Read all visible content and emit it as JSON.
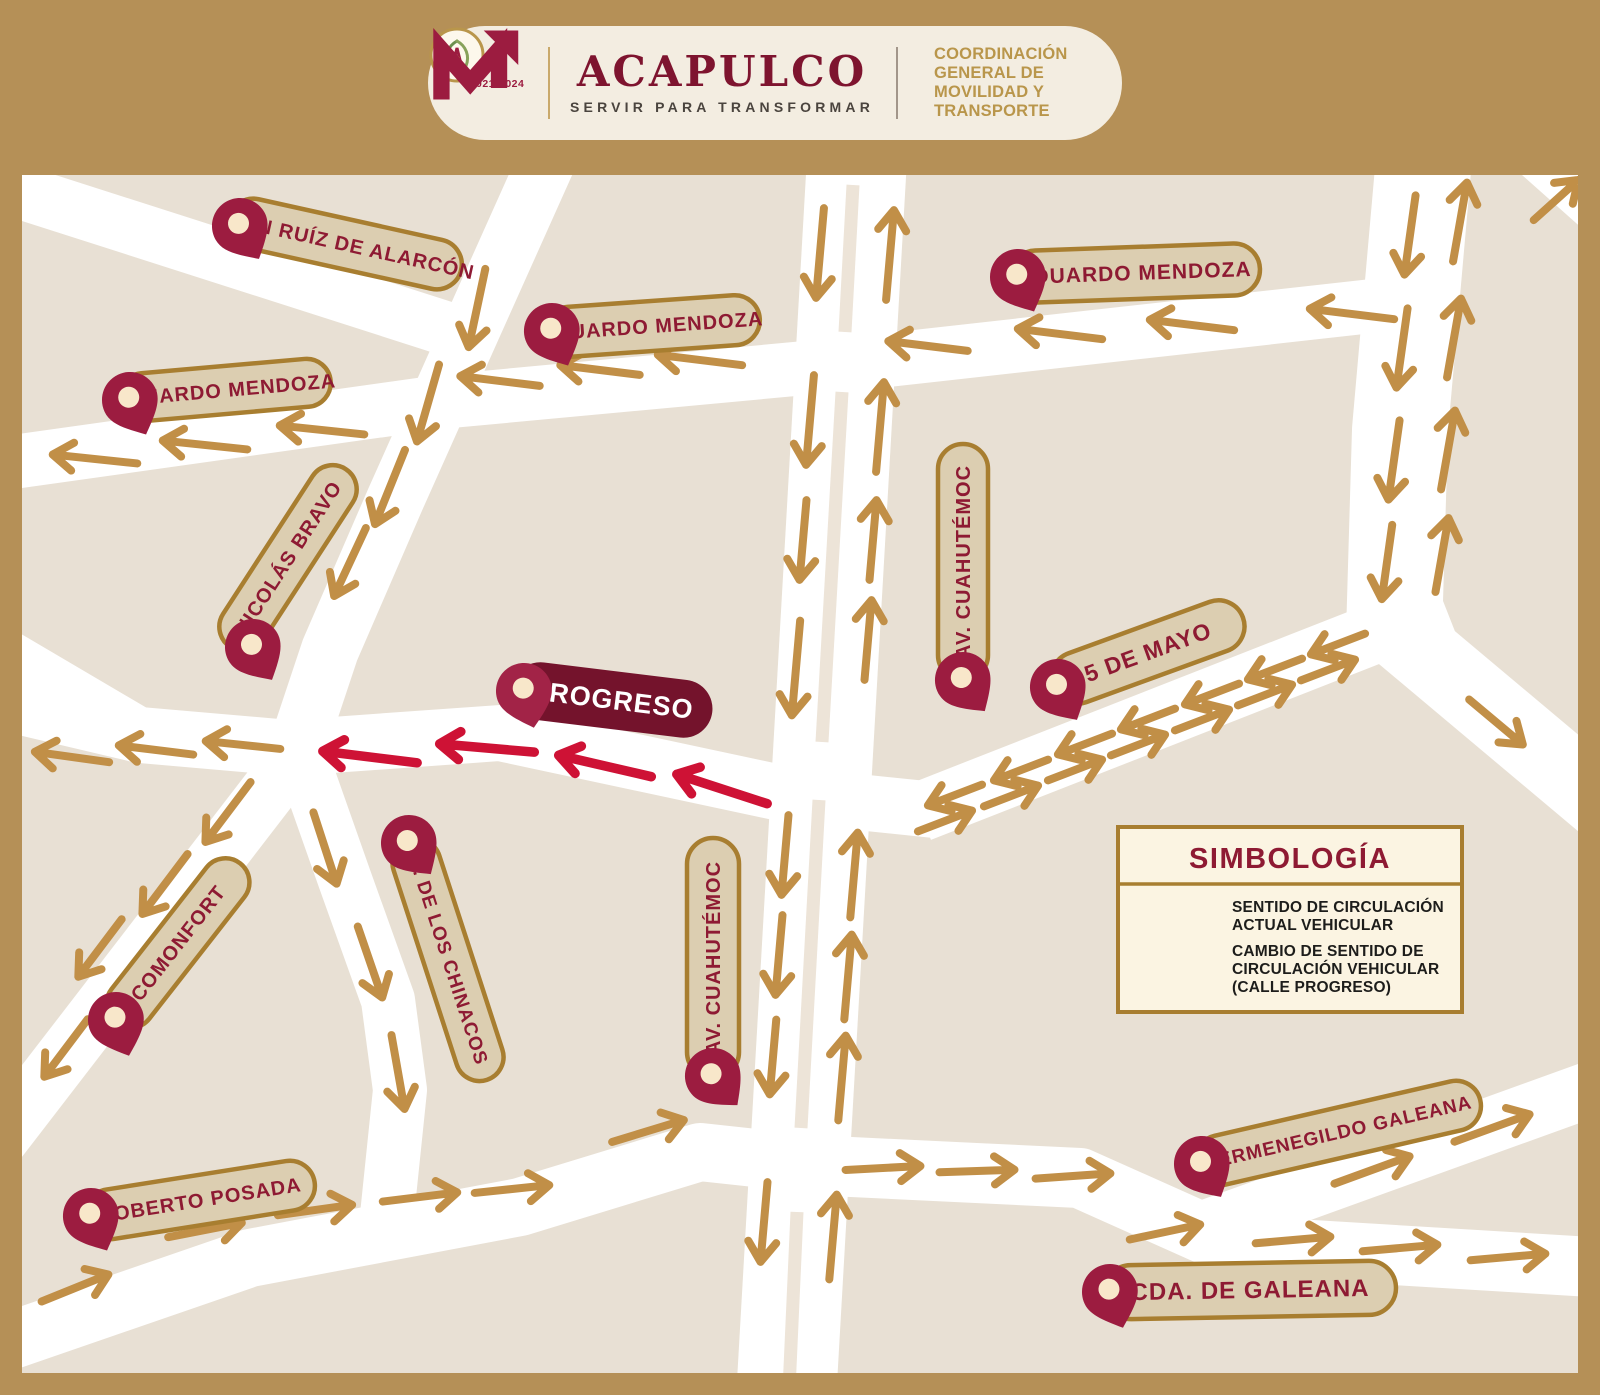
{
  "header": {
    "term": "2021-2024",
    "brand": "ACAPULCO",
    "tagline": "SERVIR PARA TRANSFORMAR",
    "agency_lines": [
      "COORDINACIÓN",
      "GENERAL DE",
      "MOVILIDAD Y",
      "TRANSPORTE"
    ]
  },
  "map": {
    "street_labels": [
      {
        "id": "juan-ruiz-de-alarcon",
        "text": "JUAN RUÍZ DE ALARCÓN"
      },
      {
        "id": "eduardo-mendoza-west",
        "text": "EDUARDO MENDOZA"
      },
      {
        "id": "eduardo-mendoza-center",
        "text": "EDUARDO MENDOZA"
      },
      {
        "id": "eduardo-mendoza-east",
        "text": "EDUARDO MENDOZA"
      },
      {
        "id": "nicolas-bravo",
        "text": "NICOLÁS BRAVO"
      },
      {
        "id": "progreso",
        "text": "PROGRESO"
      },
      {
        "id": "av-cuahutemoc-north",
        "text": "AV. CUAHUTÉMOC"
      },
      {
        "id": "cinco-de-mayo",
        "text": "5 DE MAYO"
      },
      {
        "id": "comonfort",
        "text": "COMONFORT"
      },
      {
        "id": "c-de-los-chinacos",
        "text": "C. DE LOS CHINACOS"
      },
      {
        "id": "av-cuahutemoc-south",
        "text": "AV. CUAHUTÉMOC"
      },
      {
        "id": "roberto-posada",
        "text": "ROBERTO POSADA"
      },
      {
        "id": "hermenegildo-galeana",
        "text": "HERMENEGILDO GALEANA"
      },
      {
        "id": "cda-de-galeana",
        "text": "CDA. DE GALEANA"
      }
    ],
    "icons": {
      "map_pin": "map-pin-icon",
      "current_flow": "tan-direction-arrow",
      "changed_flow": "red-direction-arrow"
    }
  },
  "legend": {
    "title": "SIMBOLOGÍA",
    "items": [
      {
        "icon": "arrow-right-tan",
        "lines": [
          "SENTIDO DE CIRCULACIÓN",
          "ACTUAL VEHICULAR"
        ]
      },
      {
        "icon": "arrow-left-red",
        "lines": [
          "CAMBIO DE SENTIDO DE",
          "CIRCULACIÓN VEHICULAR",
          "(CALLE PROGRESO)"
        ]
      }
    ]
  },
  "colors": {
    "frame": "#B59057",
    "map_background": "#E8E0D4",
    "road": "#FFFFFF",
    "current_flow_arrow": "#C18F47",
    "changed_flow_arrow": "#CE1235",
    "pin": "#9C1C40",
    "label_pill": "#DCCEB1",
    "label_border": "#A87E30",
    "label_text": "#8E1A33",
    "progreso_pill": "#74132C"
  }
}
